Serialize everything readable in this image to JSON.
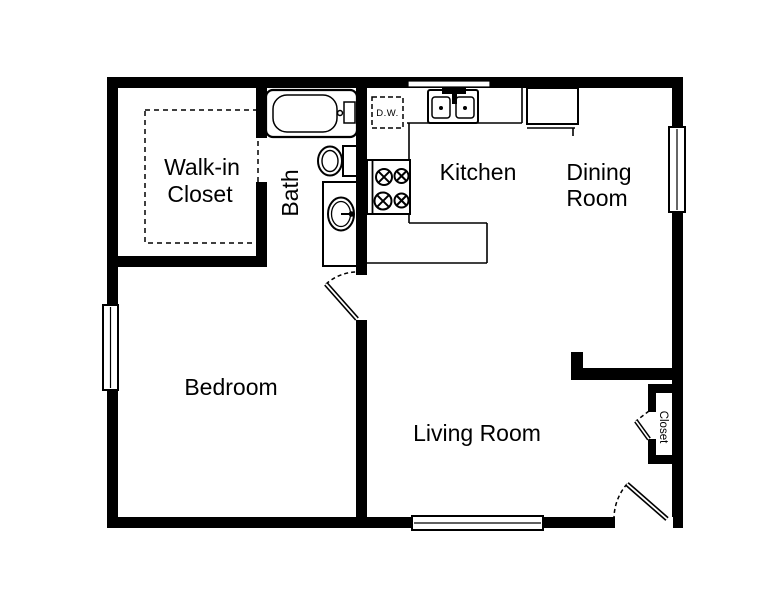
{
  "floor_plan": {
    "background_color": "#ffffff",
    "line_color": "#000000",
    "rooms": {
      "walk_in_closet": {
        "line1": "Walk-in",
        "line2": "Closet"
      },
      "bath": "Bath",
      "kitchen": "Kitchen",
      "dining_room": {
        "line1": "Dining",
        "line2": "Room"
      },
      "bedroom": "Bedroom",
      "living_room": "Living Room",
      "closet": "Closet"
    },
    "appliances": {
      "dishwasher_label": "D.W."
    },
    "fixtures": [
      "bathtub",
      "toilet",
      "vanity-sink",
      "range-4-burner",
      "double-kitchen-sink",
      "dishwasher",
      "refrigerator",
      "kitchen-counter",
      "closet-shelving"
    ],
    "openings": [
      "bedroom-door",
      "entry-door",
      "closet-bifold-door",
      "bath-to-closet-doorway"
    ],
    "windows": [
      "left-bedroom-window",
      "top-kitchen-window",
      "right-dining-window",
      "bottom-living-window"
    ]
  }
}
